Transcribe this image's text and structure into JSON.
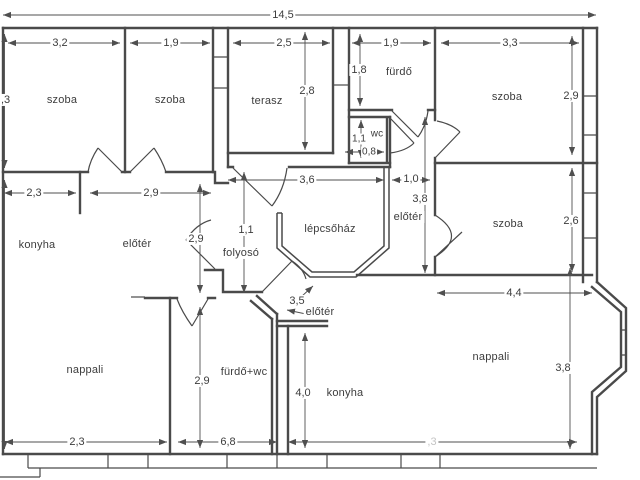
{
  "floorplan": {
    "title": "apartment floor plan",
    "overall_width": "14,5",
    "colors": {
      "wall": "#4a4a4a",
      "dimension": "#4f4f4f",
      "text": "#3d3d3d",
      "faint_text": "#c4c4c4",
      "background": "#ffffff"
    },
    "rooms": [
      {
        "name": "room-top-left",
        "label": "szoba"
      },
      {
        "name": "room-top-second",
        "label": "szoba"
      },
      {
        "name": "terrace",
        "label": "terasz"
      },
      {
        "name": "bathroom-top",
        "label": "fürdő"
      },
      {
        "name": "wc",
        "label": "wc"
      },
      {
        "name": "room-top-right",
        "label": "szoba"
      },
      {
        "name": "room-right",
        "label": "szoba"
      },
      {
        "name": "kitchen-left",
        "label": "konyha"
      },
      {
        "name": "foyer-left",
        "label": "előtér"
      },
      {
        "name": "corridor",
        "label": "folyosó"
      },
      {
        "name": "staircase",
        "label": "lépcsőház"
      },
      {
        "name": "foyer-right-apartment",
        "label": "előtér"
      },
      {
        "name": "foyer-entry",
        "label": "előtér"
      },
      {
        "name": "living-room-left",
        "label": "nappali"
      },
      {
        "name": "bathroom-wc-left",
        "label": "fürdő+wc"
      },
      {
        "name": "kitchen-right",
        "label": "konyha"
      },
      {
        "name": "living-room-right",
        "label": "nappali"
      }
    ],
    "dimensions": [
      {
        "name": "overall-width",
        "value": "14,5"
      },
      {
        "name": "room1-width",
        "value": "3,2"
      },
      {
        "name": "room2-width",
        "value": "1,9"
      },
      {
        "name": "terrace-width",
        "value": "2,5"
      },
      {
        "name": "bathroom-width",
        "value": "1,9"
      },
      {
        "name": "room-tr-width",
        "value": "3,3"
      },
      {
        "name": "terrace-depth",
        "value": "2,8"
      },
      {
        "name": "bathroom-depth",
        "value": "1,8"
      },
      {
        "name": "room-tr-depth",
        "value": "2,9"
      },
      {
        "name": "wc-depth",
        "value": "1,1"
      },
      {
        "name": "wc-width",
        "value": "0,8"
      },
      {
        "name": "kitchen-left-width",
        "value": "2,3"
      },
      {
        "name": "foyer-left-width",
        "value": "2,9"
      },
      {
        "name": "staircase-width",
        "value": "3,6"
      },
      {
        "name": "corridor-right-width",
        "value": "1,0"
      },
      {
        "name": "foyer-right-depth",
        "value": "3,8"
      },
      {
        "name": "foyer-left-depth",
        "value": "2,6"
      },
      {
        "name": "corridor-depth",
        "value": "2,9"
      },
      {
        "name": "entry-door-width",
        "value": "1,1"
      },
      {
        "name": "bath-wc-depth",
        "value": "3,5"
      },
      {
        "name": "kitchen-right-depth",
        "value": "2,9"
      },
      {
        "name": "living-right-depth",
        "value": "4,0"
      },
      {
        "name": "room-right-width",
        "value": "3,8"
      },
      {
        "name": "living-left-width",
        "value": "4,4"
      },
      {
        "name": "bath-wc-width",
        "value": "2,3"
      },
      {
        "name": "living-right-width",
        "value": "6,8"
      },
      {
        "name": "left-upper-clipped",
        "value": ",3"
      },
      {
        "name": "left-lower-clipped",
        "value": ",3"
      }
    ]
  }
}
